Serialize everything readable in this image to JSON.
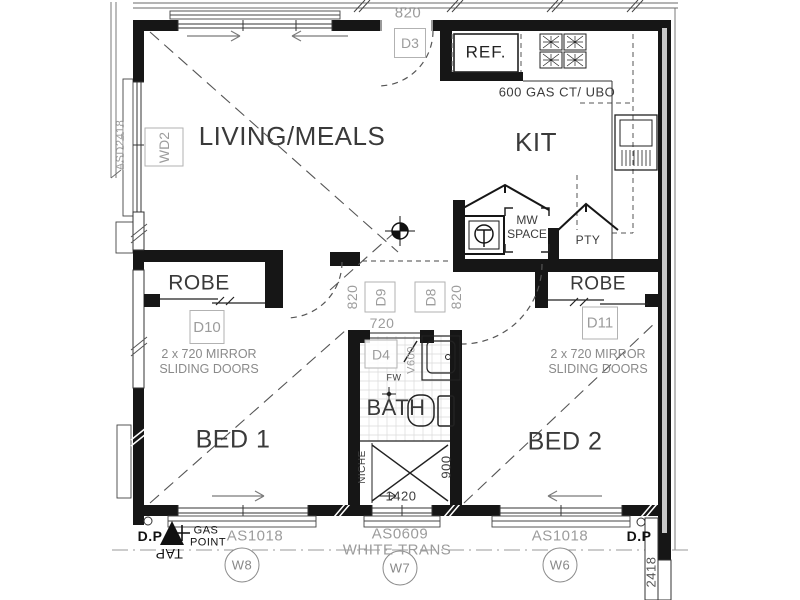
{
  "plan": {
    "rooms": {
      "living": "LIVING/MEALS",
      "kitchen": "KIT",
      "robe_left": "ROBE",
      "robe_right": "ROBE",
      "bath": "BATH",
      "bed1": "BED 1",
      "bed2": "BED 2"
    },
    "door_tags": {
      "d3": "D3",
      "d4": "D4",
      "d8": "D8",
      "d9": "D9",
      "d10": "D10",
      "d11": "D11",
      "wd2": "WD2"
    },
    "dimensions": {
      "entry_door": "820",
      "d9_door": "820",
      "d8_door": "820",
      "bath_door": "720",
      "shower_len": "1420",
      "shower_w": "900",
      "vanity": "V600",
      "right_wall": "2418",
      "left_window": "ASD2418"
    },
    "kitchen": {
      "fridge": "REF.",
      "cooktop_note": "600 GAS CT/ UBO",
      "microwave": [
        "MW",
        "SPACE"
      ],
      "pantry": "PTY"
    },
    "bath_labels": {
      "niche": "NICHE",
      "floor_waste": "FW"
    },
    "robes": {
      "left_note": [
        "2 x 720 MIRROR",
        "SLIDING DOORS"
      ],
      "right_note": [
        "2 x 720 MIRROR",
        "SLIDING DOORS"
      ]
    },
    "windows": {
      "w8": {
        "code": "AS1018",
        "tag": "W8"
      },
      "w7": {
        "code": "AS0609",
        "note": "WHITE TRANS",
        "tag": "W7"
      },
      "w6": {
        "code": "AS1018",
        "tag": "W6"
      }
    },
    "site": {
      "dp_left": "D.P",
      "dp_right": "D.P",
      "gas_point": [
        "GAS",
        "POINT"
      ],
      "tap": "TAP"
    }
  },
  "colors": {
    "line": "#161616",
    "tag_gray": "#9c9c9c",
    "dim_dark": "#444444"
  }
}
